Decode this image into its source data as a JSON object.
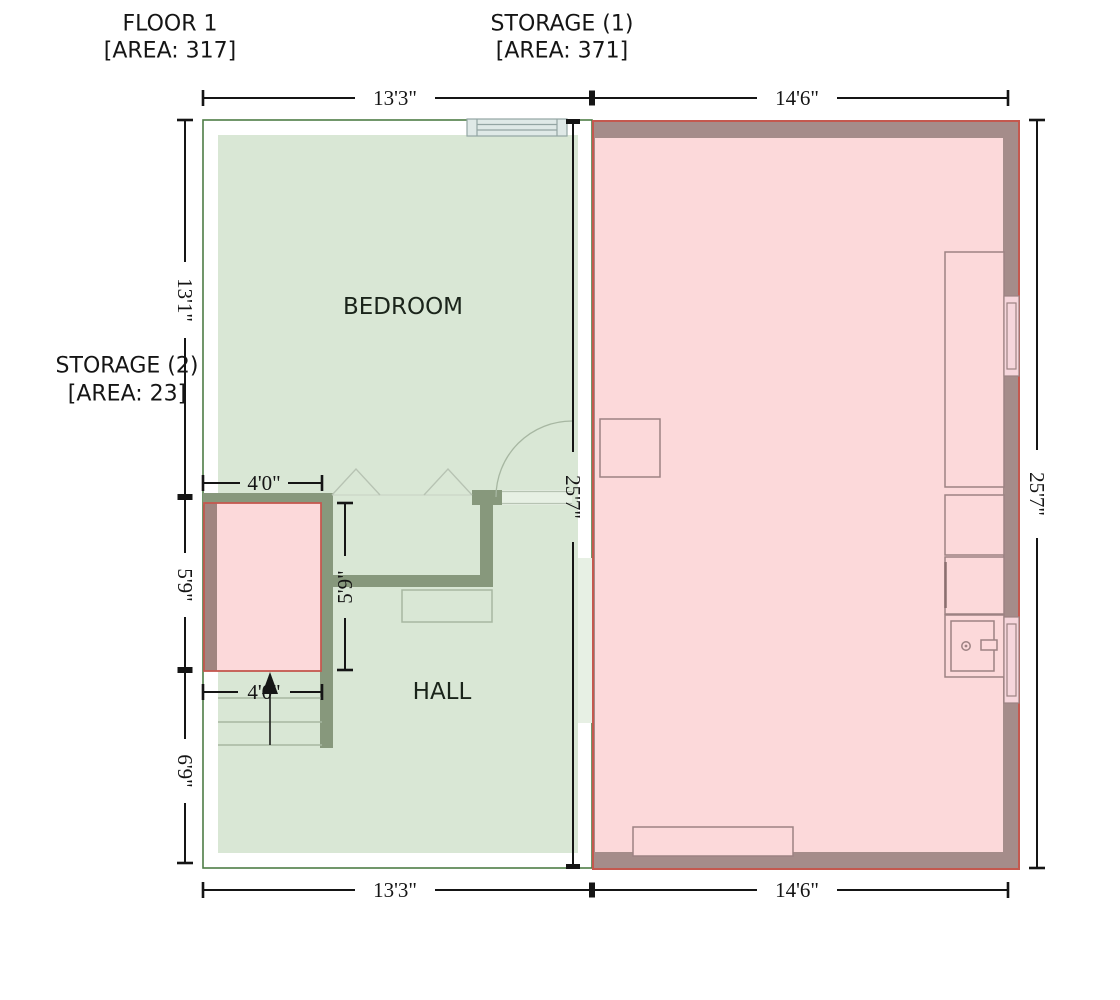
{
  "plan": {
    "floor1_label": {
      "title": "FLOOR 1",
      "area": "[AREA: 317]"
    },
    "storage1_label": {
      "title": "STORAGE (1)",
      "area": "[AREA: 371]"
    },
    "storage2_label": {
      "title": "STORAGE (2)",
      "area": "[AREA: 23]"
    },
    "rooms": {
      "bedroom": "BEDROOM",
      "hall": "HALL"
    },
    "dimensions": {
      "top_left": "13'3\"",
      "top_right": "14'6\"",
      "bottom_left": "13'3\"",
      "bottom_right": "14'6\"",
      "left_upper": "13'1\"",
      "left_middle": "5'9\"",
      "left_lower": "6'9\"",
      "right_full": "25'7\"",
      "divider_full": "25'7\"",
      "storage2_width_top": "4'0\"",
      "storage2_width_bottom": "4'0\"",
      "storage2_height": "5'9\""
    },
    "colors": {
      "green_wall": "#87987c",
      "green_room_fill": "#d9e7d5",
      "green_unit_outline": "#4e7d46",
      "pink_wall": "#a58c8a",
      "pink_room_fill": "#fcd9da",
      "pink_unit_outline": "#c4584f",
      "storage2_wall_overlap": "#a08580",
      "dimension_color": "#151515",
      "green_fixture_stroke": "#a7b7a2",
      "pink_fixture_stroke": "#9d8283",
      "window_green_fill": "#dfe9e7",
      "window_pink_fill": "#f6d6dc",
      "background": "#ffffff"
    }
  }
}
